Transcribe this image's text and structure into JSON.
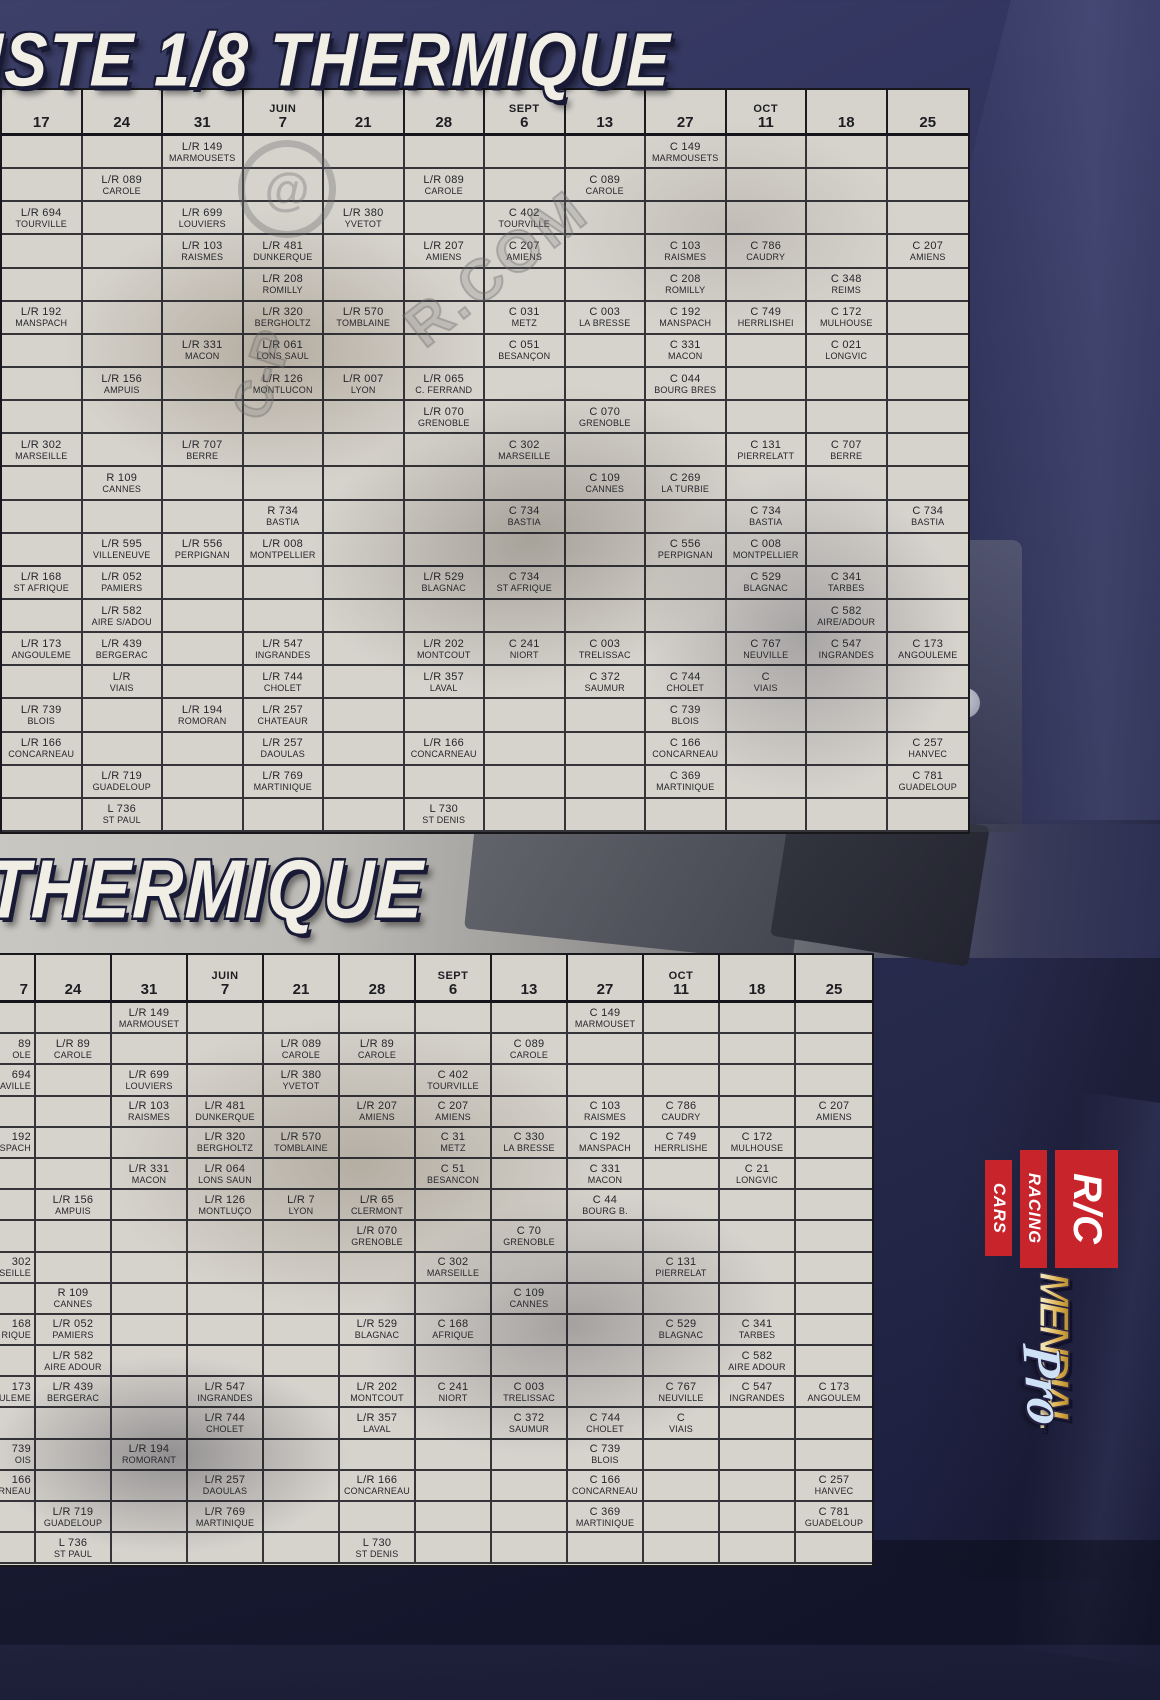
{
  "page": {
    "title_top": "ISTE 1/8 THERMIQUE",
    "title_middle": "THERMIQUE"
  },
  "watermark": {
    "at_sign": "@",
    "fragment_cp": "C-P",
    "fragment_com": "R.COM"
  },
  "logos": {
    "rc_racing": {
      "line1": "R/C",
      "line2": "RACING",
      "line3": "CARS",
      "color": "#c8242b"
    },
    "brand": {
      "word": "MENDIAL",
      "script": "Pro",
      "gold": "#d9ab45",
      "script_blue": "#cfe2f5"
    }
  },
  "colors": {
    "paper": "#d6d3cd",
    "fabric_navy": "#2e3155",
    "grid_line": "#17171c",
    "title_text": "#f1eee6",
    "logo_red": "#c8242b"
  },
  "table1": {
    "headers": [
      {
        "m": "",
        "d": "17"
      },
      {
        "m": "",
        "d": "24"
      },
      {
        "m": "",
        "d": "31"
      },
      {
        "m": "JUIN",
        "d": "7"
      },
      {
        "m": "",
        "d": "21"
      },
      {
        "m": "",
        "d": "28"
      },
      {
        "m": "SEPT",
        "d": "6"
      },
      {
        "m": "",
        "d": "13"
      },
      {
        "m": "",
        "d": "27"
      },
      {
        "m": "OCT",
        "d": "11"
      },
      {
        "m": "",
        "d": "18"
      },
      {
        "m": "",
        "d": "25"
      }
    ],
    "rows": [
      [
        "",
        "",
        "L/R 149|MARMOUSETS",
        "",
        "",
        "",
        "",
        "",
        "C 149|MARMOUSETS",
        "",
        "",
        ""
      ],
      [
        "",
        "L/R 089|CAROLE",
        "",
        "",
        "",
        "L/R 089|CAROLE",
        "",
        "C 089|CAROLE",
        "",
        "",
        "",
        ""
      ],
      [
        "L/R 694|TOURVILLE",
        "",
        "L/R 699|LOUVIERS",
        "",
        "L/R 380|YVETOT",
        "",
        "C 402|TOURVILLE",
        "",
        "",
        "",
        "",
        ""
      ],
      [
        "",
        "",
        "L/R 103|RAISMES",
        "L/R 481|DUNKERQUE",
        "",
        "L/R 207|AMIENS",
        "C 207|AMIENS",
        "",
        "C 103|RAISMES",
        "C 786|CAUDRY",
        "",
        "C 207|AMIENS"
      ],
      [
        "",
        "",
        "",
        "L/R 208|ROMILLY",
        "",
        "",
        "",
        "",
        "C 208|ROMILLY",
        "",
        "C 348|REIMS",
        ""
      ],
      [
        "L/R 192|MANSPACH",
        "",
        "",
        "L/R 320|BERGHOLTZ",
        "L/R 570|TOMBLAINE",
        "",
        "C 031|METZ",
        "C 003|LA BRESSE",
        "C 192|MANSPACH",
        "C 749|HERRLISHEI",
        "C 172|MULHOUSE",
        ""
      ],
      [
        "",
        "",
        "L/R 331|MACON",
        "L/R 061|LONS SAUL",
        "",
        "",
        "C 051|BESANÇON",
        "",
        "C 331|MACON",
        "",
        "C 021|LONGVIC",
        ""
      ],
      [
        "",
        "L/R 156|AMPUIS",
        "",
        "L/R 126|MONTLUCON",
        "L/R 007|LYON",
        "L/R 065|C. FERRAND",
        "",
        "",
        "C 044|BOURG BRES",
        "",
        "",
        ""
      ],
      [
        "",
        "",
        "",
        "",
        "",
        "L/R 070|GRENOBLE",
        "",
        "C 070|GRENOBLE",
        "",
        "",
        "",
        ""
      ],
      [
        "L/R 302|MARSEILLE",
        "",
        "L/R 707|BERRE",
        "",
        "",
        "",
        "C 302|MARSEILLE",
        "",
        "",
        "C 131|PIERRELATT",
        "C 707|BERRE",
        ""
      ],
      [
        "",
        "R 109|CANNES",
        "",
        "",
        "",
        "",
        "",
        "C 109|CANNES",
        "C 269|LA TURBIE",
        "",
        "",
        ""
      ],
      [
        "",
        "",
        "",
        "R 734|BASTIA",
        "",
        "",
        "C 734|BASTIA",
        "",
        "",
        "C 734|BASTIA",
        "",
        "C 734|BASTIA"
      ],
      [
        "",
        "L/R 595|VILLENEUVE",
        "L/R 556|PERPIGNAN",
        "L/R 008|MONTPELLIER",
        "",
        "",
        "",
        "",
        "C 556|PERPIGNAN",
        "C 008|MONTPELLIER",
        "",
        ""
      ],
      [
        "L/R 168|ST AFRIQUE",
        "L/R 052|PAMIERS",
        "",
        "",
        "",
        "L/R 529|BLAGNAC",
        "C 734|ST AFRIQUE",
        "",
        "",
        "C 529|BLAGNAC",
        "C 341|TARBES",
        ""
      ],
      [
        "",
        "L/R 582|AIRE S/ADOU",
        "",
        "",
        "",
        "",
        "",
        "",
        "",
        "",
        "C 582|AIRE/ADOUR",
        ""
      ],
      [
        "L/R 173|ANGOULEME",
        "L/R 439|BERGERAC",
        "",
        "L/R 547|INGRANDES",
        "",
        "L/R 202|MONTCOUT",
        "C 241|NIORT",
        "C 003|TRELISSAC",
        "",
        "C 767|NEUVILLE",
        "C 547|INGRANDES",
        "C 173|ANGOULEME"
      ],
      [
        "",
        "L/R|VIAIS",
        "",
        "L/R 744|CHOLET",
        "",
        "L/R 357|LAVAL",
        "",
        "C 372|SAUMUR",
        "C 744|CHOLET",
        "C|VIAIS",
        "",
        ""
      ],
      [
        "L/R 739|BLOIS",
        "",
        "L/R 194|ROMORAN",
        "L/R 257|CHATEAUR",
        "",
        "",
        "",
        "",
        "C 739|BLOIS",
        "",
        "",
        ""
      ],
      [
        "L/R 166|CONCARNEAU",
        "",
        "",
        "L/R 257|DAOULAS",
        "",
        "L/R 166|CONCARNEAU",
        "",
        "",
        "C 166|CONCARNEAU",
        "",
        "",
        "C 257|HANVEC"
      ],
      [
        "",
        "L/R 719|GUADELOUP",
        "",
        "L/R 769|MARTINIQUE",
        "",
        "",
        "",
        "",
        "C 369|MARTINIQUE",
        "",
        "",
        "C 781|GUADELOUP"
      ],
      [
        "",
        "L 736|ST PAUL",
        "",
        "",
        "",
        "L 730|ST DENIS",
        "",
        "",
        "",
        "",
        "",
        ""
      ]
    ]
  },
  "table2": {
    "cut_first_col": true,
    "headers": [
      {
        "m": "",
        "d": "7"
      },
      {
        "m": "",
        "d": "24"
      },
      {
        "m": "",
        "d": "31"
      },
      {
        "m": "JUIN",
        "d": "7"
      },
      {
        "m": "",
        "d": "21"
      },
      {
        "m": "",
        "d": "28"
      },
      {
        "m": "SEPT",
        "d": "6"
      },
      {
        "m": "",
        "d": "13"
      },
      {
        "m": "",
        "d": "27"
      },
      {
        "m": "OCT",
        "d": "11"
      },
      {
        "m": "",
        "d": "18"
      },
      {
        "m": "",
        "d": "25"
      }
    ],
    "rows": [
      [
        "",
        "",
        "L/R 149|MARMOUSET",
        "",
        "",
        "",
        "",
        "",
        "C 149|MARMOUSET",
        "",
        "",
        ""
      ],
      [
        "89|OLE",
        "L/R 89|CAROLE",
        "",
        "",
        "L/R 089|CAROLE",
        "L/R 89|CAROLE",
        "",
        "C 089|CAROLE",
        "",
        "",
        "",
        ""
      ],
      [
        "694|AVILLE",
        "",
        "L/R 699|LOUVIERS",
        "",
        "L/R 380|YVETOT",
        "",
        "C 402|TOURVILLE",
        "",
        "",
        "",
        "",
        ""
      ],
      [
        "",
        "",
        "L/R 103|RAISMES",
        "L/R 481|DUNKERQUE",
        "",
        "L/R 207|AMIENS",
        "C 207|AMIENS",
        "",
        "C 103|RAISMES",
        "C 786|CAUDRY",
        "",
        "C 207|AMIENS"
      ],
      [
        "192|SPACH",
        "",
        "",
        "L/R 320|BERGHOLTZ",
        "L/R 570|TOMBLAINE",
        "",
        "C 31|METZ",
        "C 330|LA BRESSE",
        "C 192|MANSPACH",
        "C 749|HERRLISHE",
        "C 172|MULHOUSE",
        ""
      ],
      [
        "",
        "",
        "L/R 331|MACON",
        "L/R 064|LONS SAUN",
        "",
        "",
        "C 51|BESANCON",
        "",
        "C 331|MACON",
        "",
        "C 21|LONGVIC",
        ""
      ],
      [
        "",
        "L/R 156|AMPUIS",
        "",
        "L/R 126|MONTLUÇO",
        "L/R 7|LYON",
        "L/R 65|CLERMONT",
        "",
        "",
        "C 44|BOURG B.",
        "",
        "",
        ""
      ],
      [
        "",
        "",
        "",
        "",
        "",
        "L/R 070|GRENOBLE",
        "",
        "C 70|GRENOBLE",
        "",
        "",
        "",
        ""
      ],
      [
        "302|SEILLE",
        "",
        "",
        "",
        "",
        "",
        "C 302|MARSEILLE",
        "",
        "",
        "C 131|PIERRELAT",
        "",
        ""
      ],
      [
        "",
        "R 109|CANNES",
        "",
        "",
        "",
        "",
        "",
        "C 109|CANNES",
        "",
        "",
        "",
        ""
      ],
      [
        "168|RIQUE",
        "L/R 052|PAMIERS",
        "",
        "",
        "",
        "L/R 529|BLAGNAC",
        "C 168|AFRIQUE",
        "",
        "",
        "C 529|BLAGNAC",
        "C 341|TARBES",
        ""
      ],
      [
        "",
        "L/R 582|AIRE ADOUR",
        "",
        "",
        "",
        "",
        "",
        "",
        "",
        "",
        "C 582|AIRE ADOUR",
        ""
      ],
      [
        "173|ULEME",
        "L/R 439|BERGERAC",
        "",
        "L/R 547|INGRANDES",
        "",
        "L/R 202|MONTCOUT",
        "C 241|NIORT",
        "C 003|TRELISSAC",
        "",
        "C 767|NEUVILLE",
        "C 547|INGRANDES",
        "C 173|ANGOULEM"
      ],
      [
        "",
        "",
        "",
        "L/R 744|CHOLET",
        "",
        "L/R 357|LAVAL",
        "",
        "C 372|SAUMUR",
        "C 744|CHOLET",
        "C|VIAIS",
        "",
        ""
      ],
      [
        "739|OIS",
        "",
        "L/R 194|ROMORANT",
        "",
        "",
        "",
        "",
        "",
        "C 739|BLOIS",
        "",
        "",
        ""
      ],
      [
        "166|RNEAU",
        "",
        "",
        "L/R 257|DAOULAS",
        "",
        "L/R 166|CONCARNEAU",
        "",
        "",
        "C 166|CONCARNEAU",
        "",
        "",
        "C 257|HANVEC"
      ],
      [
        "",
        "L/R 719|GUADELOUP",
        "",
        "L/R 769|MARTINIQUE",
        "",
        "",
        "",
        "",
        "C 369|MARTINIQUE",
        "",
        "",
        "C 781|GUADELOUP"
      ],
      [
        "",
        "L 736|ST PAUL",
        "",
        "",
        "",
        "L 730|ST DENIS",
        "",
        "",
        "",
        "",
        "",
        ""
      ]
    ]
  }
}
